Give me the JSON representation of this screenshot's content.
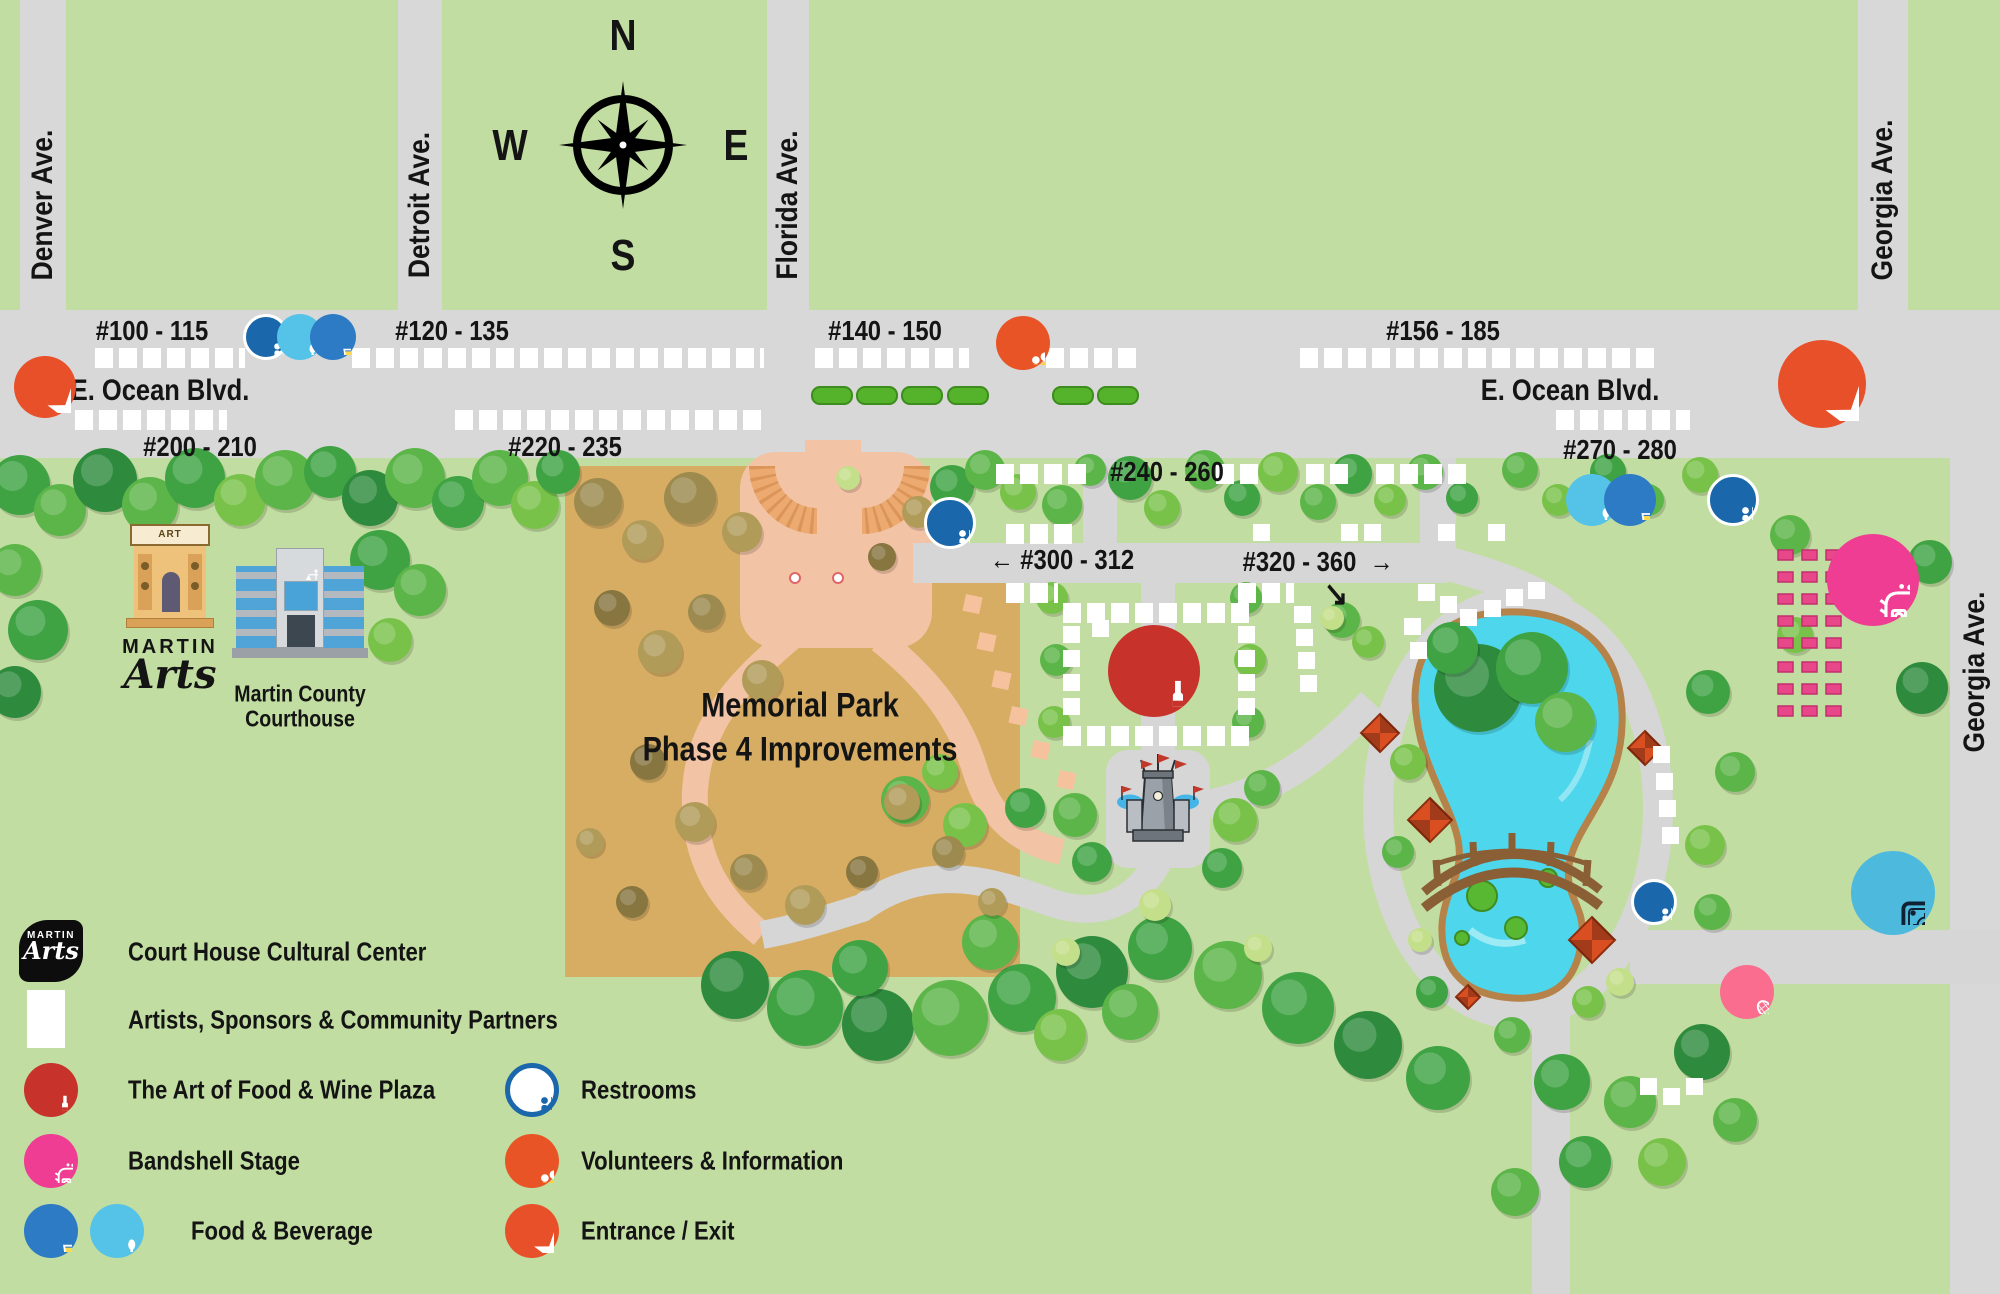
{
  "streets": {
    "denver": "Denver Ave.",
    "detroit": "Detroit Ave.",
    "florida": "Florida Ave.",
    "georgia_top": "Georgia Ave.",
    "georgia_side": "Georgia Ave.",
    "ocean_blvd_left": "E. Ocean Blvd.",
    "ocean_blvd_right": "E. Ocean Blvd."
  },
  "compass": {
    "north": "N",
    "south": "S",
    "east": "E",
    "west": "W"
  },
  "booths": {
    "row_100": "#100 - 115",
    "row_120": "#120 - 135",
    "row_140": "#140 - 150",
    "row_156": "#156 - 185",
    "row_200": "#200 - 210",
    "row_220": "#220 - 235",
    "row_240": "#240 - 260",
    "row_270": "#270 - 280",
    "row_300": "#300 - 312",
    "row_320": "#320 - 360",
    "arrow_left": "←",
    "arrow_right": "→",
    "arrow_diag": "↘"
  },
  "landmarks": {
    "memorial_park_line1": "Memorial Park",
    "memorial_park_line2": "Phase 4 Improvements",
    "art_gallery_sign": "ART GALLERY",
    "martin_arts_word1": "Martin",
    "martin_arts_word2": "Arts",
    "courthouse_line1": "Martin County",
    "courthouse_line2": "Courthouse"
  },
  "legend": {
    "left": [
      {
        "icon": "martin-arts-logo",
        "label": "Court House Cultural Center"
      },
      {
        "icon": "white-booth-square",
        "label": "Artists, Sponsors & Community Partners"
      },
      {
        "icon": "wine-circle",
        "label": "The Art of Food & Wine Plaza"
      },
      {
        "icon": "bandshell-circle",
        "label": "Bandshell Stage"
      },
      {
        "icon": "beverage-and-utensils-circles",
        "label": "Food & Beverage"
      }
    ],
    "right": [
      {
        "icon": "restrooms-circle",
        "label": "Restrooms"
      },
      {
        "icon": "volunteers-circle",
        "label": "Volunteers & Information"
      },
      {
        "icon": "entrance-star-circle",
        "label": "Entrance / Exit"
      }
    ]
  },
  "colors": {
    "park_green": "#c2dda1",
    "street_gray": "#d8d8d8",
    "booth_white": "#ffffff",
    "memorial_tan": "#d7ad64",
    "plaza_pink": "#f2c3a4",
    "pond_blue": "#4ed7ec",
    "restroom_blue": "#1a68ab",
    "food_lightblue": "#55c3e8",
    "beverage_blue": "#2d7bc4",
    "wine_red": "#c7322b",
    "volunteer_orange": "#e85426",
    "entrance_orange": "#e8502a",
    "bandshell_pink": "#ee3d92",
    "splashpad_blue": "#4db9dd",
    "tennis_pink": "#fb6d8e"
  }
}
